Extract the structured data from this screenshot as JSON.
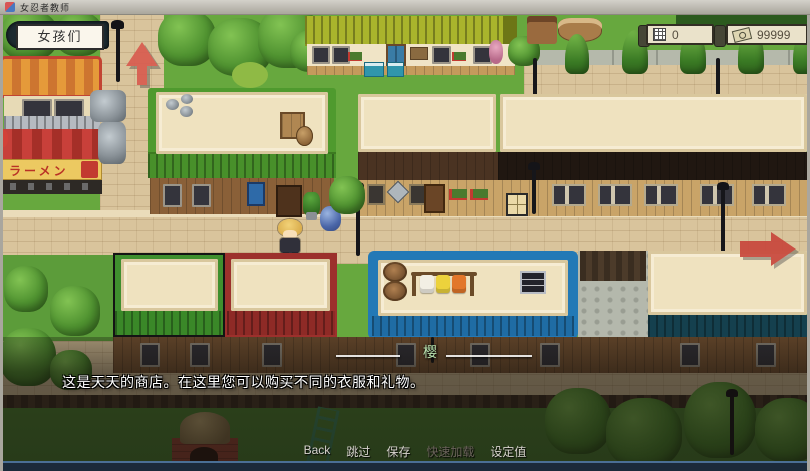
{
  "window": {
    "title": "女忍者教师"
  },
  "hud": {
    "location_button": {
      "label": "女孩们"
    },
    "counters": [
      {
        "icon": "calendar-grid-icon",
        "value": "0"
      },
      {
        "icon": "money-icon",
        "value": "99999"
      }
    ],
    "up_arrow": "map-exit-up",
    "right_arrow": "map-exit-right"
  },
  "map": {
    "ramen_sign": "ラーメン"
  },
  "dialogue": {
    "speaker": "樱",
    "text": "这是天天的商店。在这里您可以购买不同的衣服和礼物。"
  },
  "quick_menu": {
    "items": [
      {
        "label": "Back",
        "enabled": true
      },
      {
        "label": "跳过",
        "enabled": true
      },
      {
        "label": "保存",
        "enabled": true
      },
      {
        "label": "快速加载",
        "enabled": false
      },
      {
        "label": "设定值",
        "enabled": true
      }
    ]
  },
  "colors": {
    "arrow_red": "#c8473c",
    "money_text": "#564e40",
    "speaker_name": "#b9e2ae",
    "roof_green": "#4f9a2e",
    "roof_blue": "#2379b6",
    "roof_red": "#9c302c"
  }
}
